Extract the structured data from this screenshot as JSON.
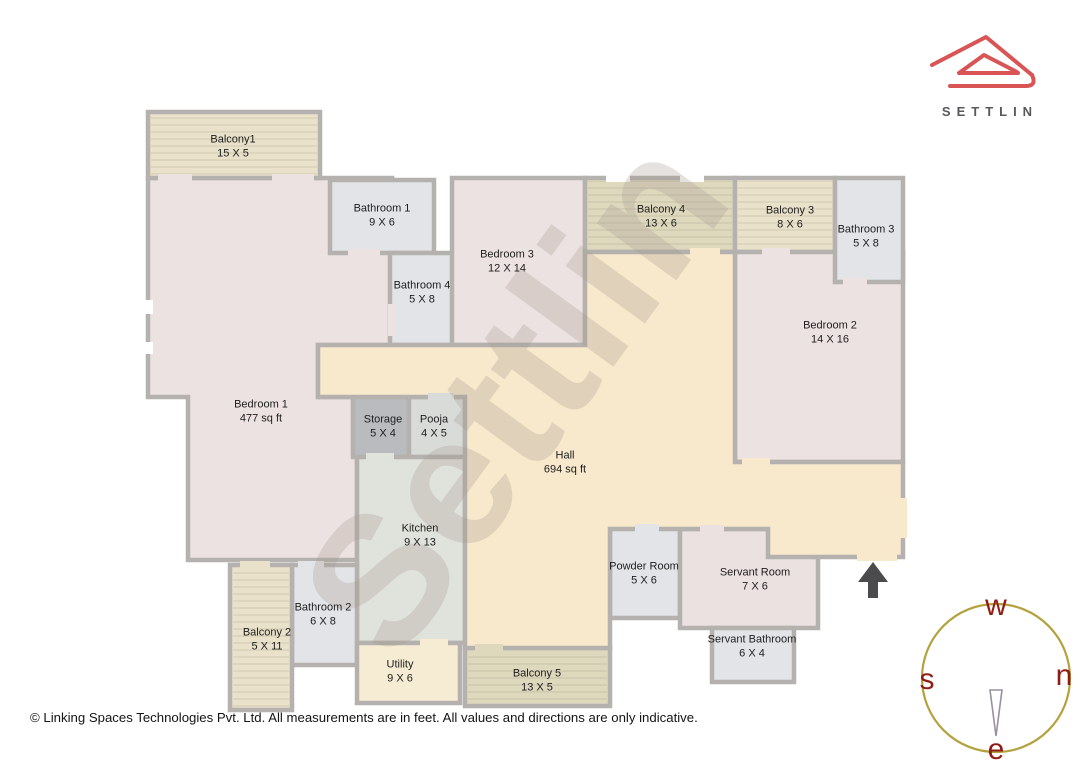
{
  "branding": {
    "logo_text": "SETTLIN"
  },
  "watermark_text": "Settlin",
  "footer_text": "© Linking Spaces Technologies Pvt. Ltd. All measurements are in feet. All values and directions are only indicative.",
  "compass": {
    "top": "w",
    "left": "s",
    "right": "n",
    "bottom": "e"
  },
  "rooms": {
    "balcony1": {
      "name": "Balcony1",
      "dims": "15 X 5"
    },
    "bedroom1": {
      "name": "Bedroom 1",
      "dims": "477 sq ft"
    },
    "bathroom1": {
      "name": "Bathroom 1",
      "dims": "9 X 6"
    },
    "bathroom4": {
      "name": "Bathroom 4",
      "dims": "5 X 8"
    },
    "bedroom3": {
      "name": "Bedroom 3",
      "dims": "12 X 14"
    },
    "balcony4": {
      "name": "Balcony 4",
      "dims": "13 X 6"
    },
    "balcony3": {
      "name": "Balcony 3",
      "dims": "8 X 6"
    },
    "bathroom3": {
      "name": "Bathroom 3",
      "dims": "5 X 8"
    },
    "bedroom2": {
      "name": "Bedroom 2",
      "dims": "14 X 16"
    },
    "storage": {
      "name": "Storage",
      "dims": "5 X 4"
    },
    "pooja": {
      "name": "Pooja",
      "dims": "4 X 5"
    },
    "hall": {
      "name": "Hall",
      "dims": "694 sq ft"
    },
    "kitchen": {
      "name": "Kitchen",
      "dims": "9 X 13"
    },
    "powder_room": {
      "name": "Powder Room",
      "dims": "5 X 6"
    },
    "servant_room": {
      "name": "Servant Room",
      "dims": "7 X 6"
    },
    "bathroom2": {
      "name": "Bathroom 2",
      "dims": "6 X 8"
    },
    "balcony2": {
      "name": "Balcony 2",
      "dims": "5 X 11"
    },
    "utility": {
      "name": "Utility",
      "dims": "9 X 6"
    },
    "balcony5": {
      "name": "Balcony 5",
      "dims": "13 X 5"
    },
    "servant_bathroom": {
      "name": "Servant Bathroom",
      "dims": "6 X 4"
    }
  },
  "colors": {
    "wall": "#b4b1ae",
    "bedroom": "#ece2e1",
    "hall": "#f8e8cc",
    "balcony_beige": "#e9e1ca",
    "balcony_khaki": "#ded8bd",
    "bathroom": "#e2e4e7",
    "kitchen": "#e0e2dc",
    "storage": "#b9bbbf",
    "pooja": "#d9dbd9",
    "utility": "#f6ecd3",
    "servant": "#ebe1e0",
    "brand_red": "#d95454",
    "logo_text_color": "#58595b",
    "compass_ring": "#b3a23d",
    "compass_letters": "#8e1d15",
    "needle": "#9c8fa0",
    "entrance_arrow": "#4b4b4d",
    "watermark": "rgba(169,154,146,0.30)",
    "white": "#ffffff"
  }
}
